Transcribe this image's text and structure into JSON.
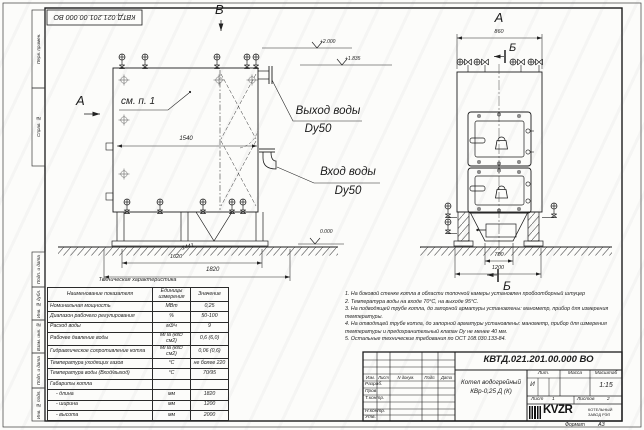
{
  "sheet": {
    "stamp_top": "КВТД.021.201.00.000 ВО"
  },
  "frame_left": {
    "labels": [
      "Перв. примен.",
      "Справ. №",
      "Подп. и дата",
      "Инв. № дубл.",
      "Взам. инв. №",
      "Подп. и дата",
      "Инв. № подл."
    ]
  },
  "views": {
    "front": {
      "view_label": "В",
      "arrow_label": "А",
      "see_note": "см. п. 1",
      "dim_1540": "1540",
      "dim_1441": "1441",
      "dim_1620": "1620",
      "dim_1820": "1820",
      "elev_top": "+2.000",
      "elev_pipe": "+1.835",
      "elev_zero": "0.000",
      "outlet_line1": "Выход воды",
      "outlet_line2": "Dy50",
      "inlet_line1": "Вход воды",
      "inlet_line2": "Dy50"
    },
    "side": {
      "view_label": "А",
      "dim_860": "860",
      "dim_700": "700",
      "dim_1200": "1200",
      "section_top": "Б",
      "section_bottom": "Б"
    }
  },
  "tech_table": {
    "title": "Техническая характеристика",
    "headers": [
      "Наименование показателя",
      "Единицы измерения",
      "Значение"
    ],
    "rows": [
      [
        "Номинальная мощность",
        "МВт",
        "0,25"
      ],
      [
        "Диапазон рабочего регулирования",
        "%",
        "50-100"
      ],
      [
        "Расход воды",
        "м3/ч",
        "9"
      ],
      [
        "Рабочее давление воды",
        "МПа (кгс/см2)",
        "0,6 (6,0)"
      ],
      [
        "Гидравлическое сопротивление котла",
        "МПа (кгс/см2)",
        "0,06 (0,6)"
      ],
      [
        "Температура уходящих газов",
        "°С",
        "не более 220"
      ],
      [
        "Температура воды (Вход/выход)",
        "°С",
        "70/95"
      ],
      [
        "Габариты котла",
        "",
        ""
      ],
      [
        "- длина",
        "мм",
        "1820"
      ],
      [
        "- ширина",
        "мм",
        "1200"
      ],
      [
        "- высота",
        "мм",
        "2000"
      ]
    ]
  },
  "notes": [
    "1. На боковой стенке котла в области топочной камеры установлен пробоотборный штуцер",
    "2. Температура воды на входе 70°С, на выходе 95°С.",
    "3. На подводящей трубе котла, до запорной арматуры установлены: манометр, прибор для измерения температуры.",
    "4. На отводящей трубе котла, до запорной арматуры установлены: манометр, прибор для измерения температуры и предохранительный клапан Dy не менее 40 мм.",
    "5. Остальные технические требования по ОСТ 108.030.133-84."
  ],
  "title_block": {
    "doc_number": "КВТД.021.201.00.000  ВО",
    "name_line1": "Котел водогрейный",
    "name_line2": "КВр-0,25 Д (К)",
    "col_headers": [
      "Изм.",
      "Лист",
      "N докум.",
      "Подп.",
      "Дата"
    ],
    "row_labels": [
      "Разраб.",
      "Пров.",
      "Т.контр.",
      "Н.контр.",
      "Утв."
    ],
    "lit_label": "Лит.",
    "lit_value": "И",
    "mass_label": "Масса",
    "scale_label": "Масштаб",
    "scale_value": "1:15",
    "sheet_label": "Лист",
    "sheet_value": "1",
    "sheets_label": "Листов",
    "sheets_value": "2",
    "logo_text": "KVZR",
    "company_line1": "КОТЕЛЬНЫЙ",
    "company_line2": "ЗАВОД РЭП",
    "format_label": "Формат",
    "format_value": "А3"
  }
}
